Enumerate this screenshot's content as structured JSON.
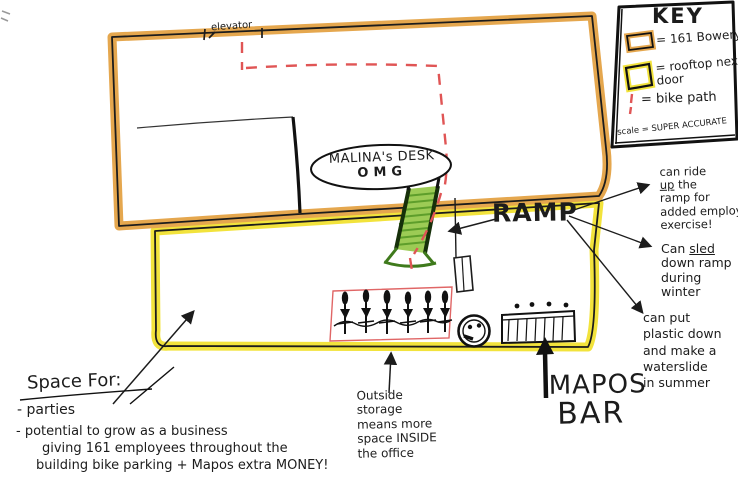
{
  "title": "Rooftop plan sketch - 161 Bowery",
  "colors": {
    "bowery_highlight": "#E5A74E",
    "rooftop_highlight": "#F2E33C",
    "bike_path": "#E05555",
    "ramp_green": "#9CCB55",
    "ink": "#1C1C1C"
  },
  "key": {
    "title": "KEY",
    "items": [
      {
        "symbol": "orange-rect-icon",
        "label": "= 161 Bowery"
      },
      {
        "symbol": "yellow-rect-icon",
        "label": "= rooftop next door"
      },
      {
        "symbol": "red-dash-icon",
        "label": "= bike path"
      }
    ],
    "scale_note": "scale = SUPER ACCURATE"
  },
  "map": {
    "elevator_label": "elevator",
    "desk_label": "MALINA's DESK",
    "desk_sub": "OMG",
    "ramp_label": "RAMP"
  },
  "notes": {
    "ride": {
      "l1": "can ride",
      "u": "up",
      "l2b": "the",
      "l3": "ramp for",
      "l4": "added employee",
      "l5": "exercise!"
    },
    "sled": {
      "l1a": "Can",
      "u": "sled",
      "l2": "down ramp",
      "l3": "during",
      "l4": "winter"
    },
    "slide": "can put\nplastic down\nand make a\nwaterslide\nin summer",
    "storage": "Outside\nstorage\nmeans more\nspace INSIDE\nthe office",
    "bar_line1": "MAPOS",
    "bar_line2": "BAR"
  },
  "space_section": {
    "heading": "Space For:",
    "bullet1": "- parties",
    "bullet2_lines": [
      "- potential to grow as a business",
      "giving 161 employees throughout the",
      "building bike parking + Mapos extra MONEY!"
    ]
  }
}
